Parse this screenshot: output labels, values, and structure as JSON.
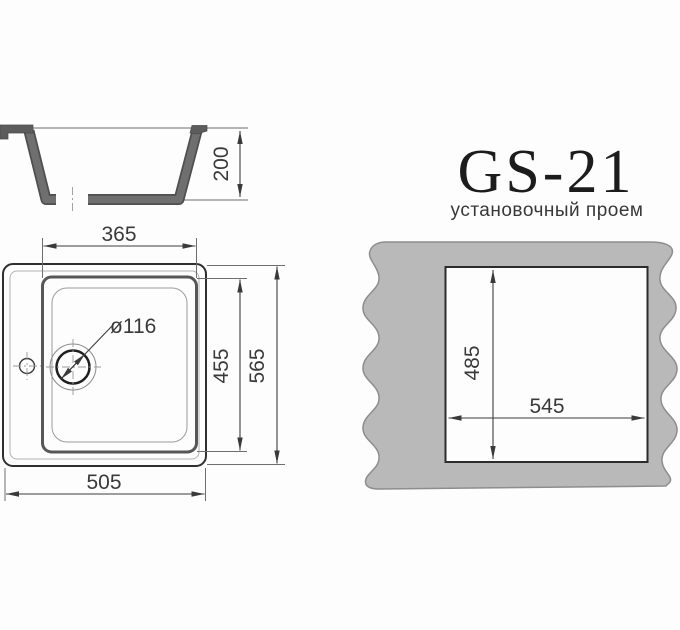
{
  "title": {
    "model": "GS-21",
    "subtitle": "установочный проем"
  },
  "cross_section": {
    "height": "200"
  },
  "plan_view": {
    "bowl_width": "365",
    "bowl_depth": "455",
    "overall_depth": "565",
    "overall_width": "505",
    "drain_diameter": "ø116"
  },
  "installation_opening": {
    "depth": "485",
    "width": "545"
  },
  "colors": {
    "line": "#3d3d3d",
    "sink_body": "#6f6f6f",
    "sink_body_edge": "#4f4f4f",
    "countertop": "#b9b9b9",
    "countertop_edge": "#8d8d8d",
    "background": "#fdfdfd"
  }
}
